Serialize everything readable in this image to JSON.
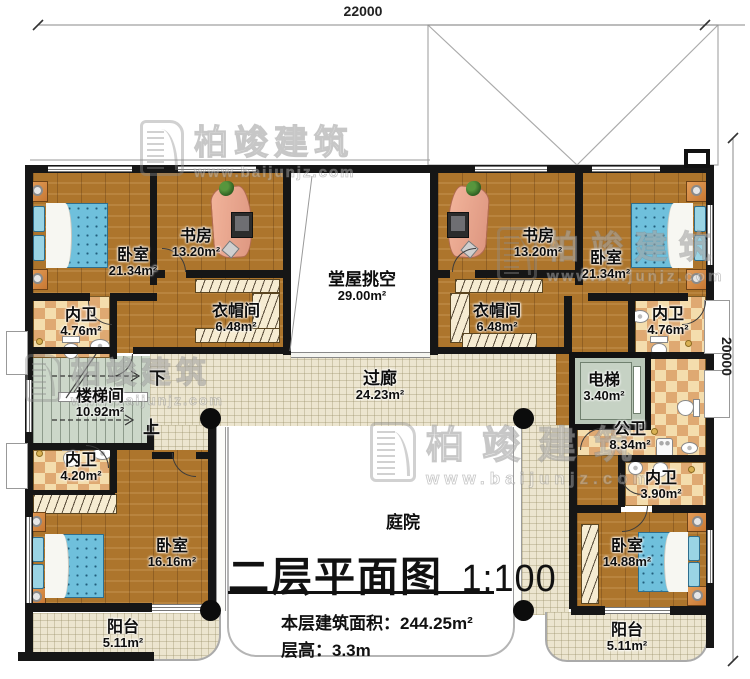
{
  "dimensions": {
    "top": "22000",
    "right": "20000"
  },
  "watermark": {
    "brand": "柏竣建筑",
    "url": "www.baijunjz.com"
  },
  "rooms": {
    "bedroom_tl": {
      "label": "卧室",
      "area": "21.34m²"
    },
    "study_l": {
      "label": "书房",
      "area": "13.20m²"
    },
    "hall_void": {
      "label": "堂屋挑空",
      "area": "29.00m²"
    },
    "study_r": {
      "label": "书房",
      "area": "13.20m²"
    },
    "bedroom_tr": {
      "label": "卧室",
      "area": "21.34m²"
    },
    "bath_tl": {
      "label": "内卫",
      "area": "4.76m²"
    },
    "cloak_l": {
      "label": "衣帽间",
      "area": "6.48m²"
    },
    "cloak_r": {
      "label": "衣帽间",
      "area": "6.48m²"
    },
    "bath_tr": {
      "label": "内卫",
      "area": "4.76m²"
    },
    "stairwell": {
      "label": "楼梯间",
      "area": "10.92m²",
      "down": "下",
      "up": "上"
    },
    "corridor": {
      "label": "过廊",
      "area": "24.23m²"
    },
    "elevator": {
      "label": "电梯",
      "area": "3.40m²"
    },
    "public_bath": {
      "label": "公卫",
      "area": "8.34m²"
    },
    "bath_bl": {
      "label": "内卫",
      "area": "4.20m²"
    },
    "bath_br": {
      "label": "内卫",
      "area": "3.90m²"
    },
    "bedroom_bl": {
      "label": "卧室",
      "area": "16.16m²"
    },
    "bedroom_br": {
      "label": "卧室",
      "area": "14.88m²"
    },
    "balcony_l": {
      "label": "阳台",
      "area": "5.11m²"
    },
    "balcony_r": {
      "label": "阳台",
      "area": "5.11m²"
    },
    "courtyard": {
      "label": "庭院"
    }
  },
  "titleblock": {
    "title": "二层平面图",
    "scale": "1:100",
    "area_text": "本层建筑面积：244.25m²",
    "height_text": "层高：3.3m"
  }
}
